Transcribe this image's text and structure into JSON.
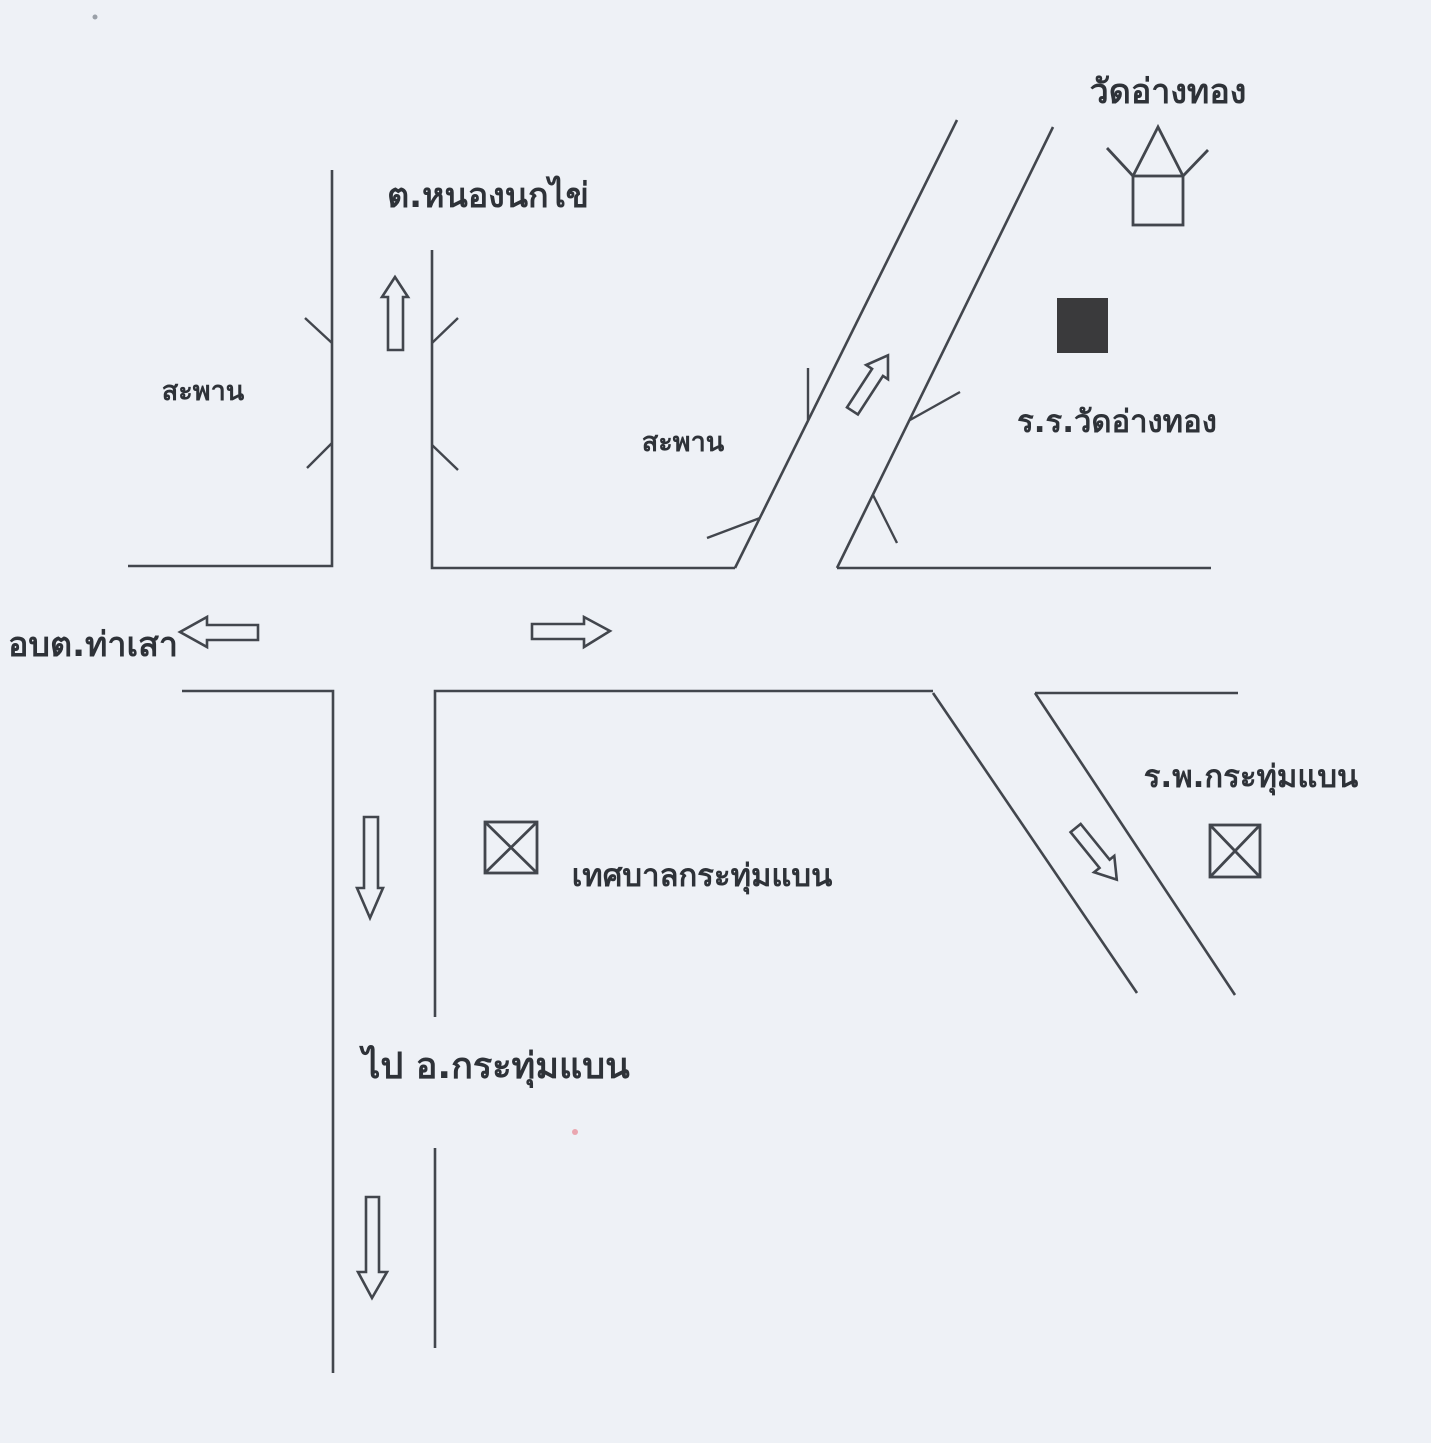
{
  "map": {
    "background_color": "#eef1f6",
    "line_color": "#42464d",
    "school_marker_fill": "#3a3a3c",
    "labels": {
      "temple": "วัดอ่างทอง",
      "subdistrict_north": "ต.หนองนกไข่",
      "bridge_west": "สะพาน",
      "bridge_middle": "สะพาน",
      "school": "ร.ร.วัดอ่างทอง",
      "sao_west": "อบต.ท่าเสา",
      "municipality": "เทศบาลกระทุ่มแบน",
      "hospital": "ร.พ.กระทุ่มแบน",
      "route_south": "ไป อ.กระทุ่มแบน"
    },
    "icons": {
      "temple": "temple-house-icon",
      "school": "filled-square-marker",
      "municipality": "crossed-box-marker",
      "hospital": "crossed-box-marker",
      "bridges": "double-tick-bridge-marks",
      "direction_arrows": [
        "arrow-up",
        "arrow-left",
        "arrow-right",
        "arrow-up-right",
        "arrow-down",
        "arrow-down-right",
        "arrow-down"
      ]
    }
  }
}
